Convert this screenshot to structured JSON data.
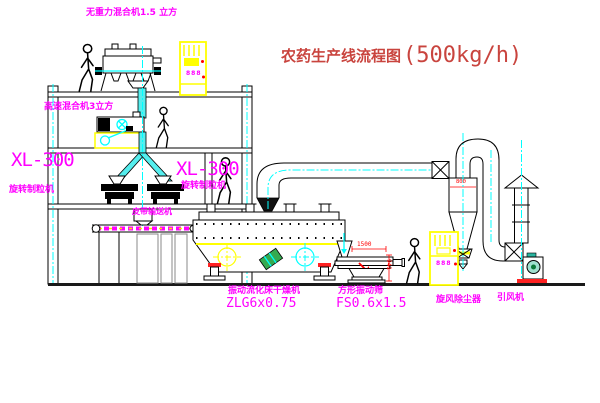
{
  "title": {
    "name": "农药生产线流程图",
    "capacity": "(500kg/h)"
  },
  "labels": {
    "gravity_mixer": "无重力混合机1.5 立方",
    "high_speed_mixer": "高速混合机3立方",
    "granulator_model": "XL-300",
    "granulator_name": "旋转制粒机",
    "belt_conveyor": "皮带输送机",
    "dryer_name": "振动流化床干燥机",
    "dryer_model": "ZLG6x0.75",
    "sieve_name": "方形振动筛",
    "sieve_model": "FS0.6x1.5",
    "cyclone": "旋风除尘器",
    "fan": "引风机"
  },
  "dimensions": {
    "sieve_length": "1500",
    "sieve_height": "941",
    "cyclone_diameter": "800"
  },
  "cabinet_display": "888",
  "colors": {
    "label": "#ff00ff",
    "title": "#c9443e",
    "dimension": "#ff0000",
    "centerline": "#00ffff",
    "cabinet": "#ffff00",
    "motor": "#35aa50",
    "fan_teal": "#9fe0d0",
    "base": "#ff2222",
    "pier": "#8a8a8a",
    "belt": "#ff00ff"
  }
}
